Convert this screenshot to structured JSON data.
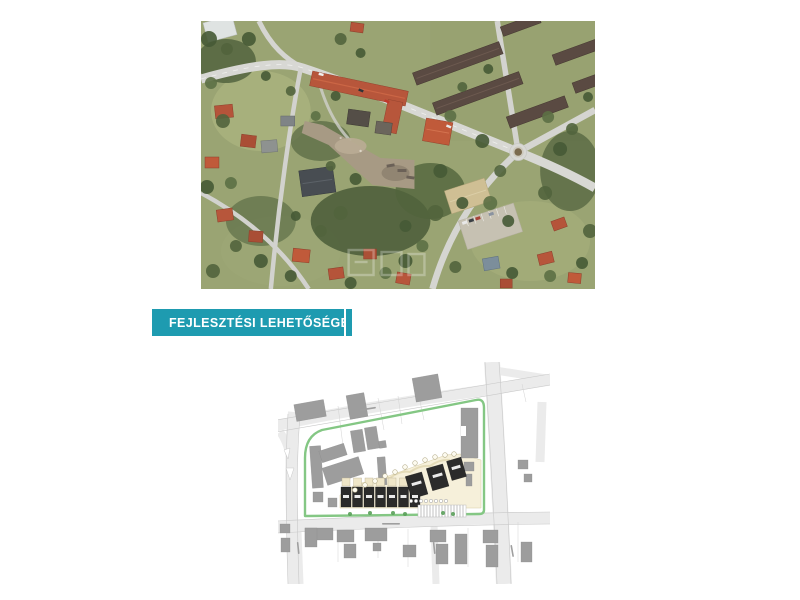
{
  "page": {
    "width": 800,
    "height": 600,
    "background": "#ffffff"
  },
  "aerial_photo": {
    "alt": "Aerial satellite photo of the neighbourhood: crossing roads with a roundabout at right, red tiled roofs, dark row houses at top right, dense tree cover and a cleared brown development plot in the centre",
    "colors": {
      "vegetation": "#54663f",
      "roads": "#d8d8d4",
      "red_roofs": "#b7563b",
      "row_house_roofs": "#5a4a42",
      "cleared_plot": "#a79a84"
    }
  },
  "section_banner": {
    "label": "FEJLESZTÉSI LEHETŐSÉGEK",
    "background_color": "#1e9bb0",
    "text_color": "#ffffff"
  },
  "site_plan": {
    "alt": "Development site plan: light grey streets, grey existing buildings, green plot boundary, beige development parcel with a row of dark planned row-house footprints, tree circles and hatched parking",
    "colors": {
      "boundary_green": "#84c784",
      "parcel_beige": "#f6f0da",
      "existing_buildings": "#9d9d9d",
      "planned_buildings": "#2b2b2b",
      "streets": "#ebebeb",
      "trees": "#5aa05a"
    }
  }
}
